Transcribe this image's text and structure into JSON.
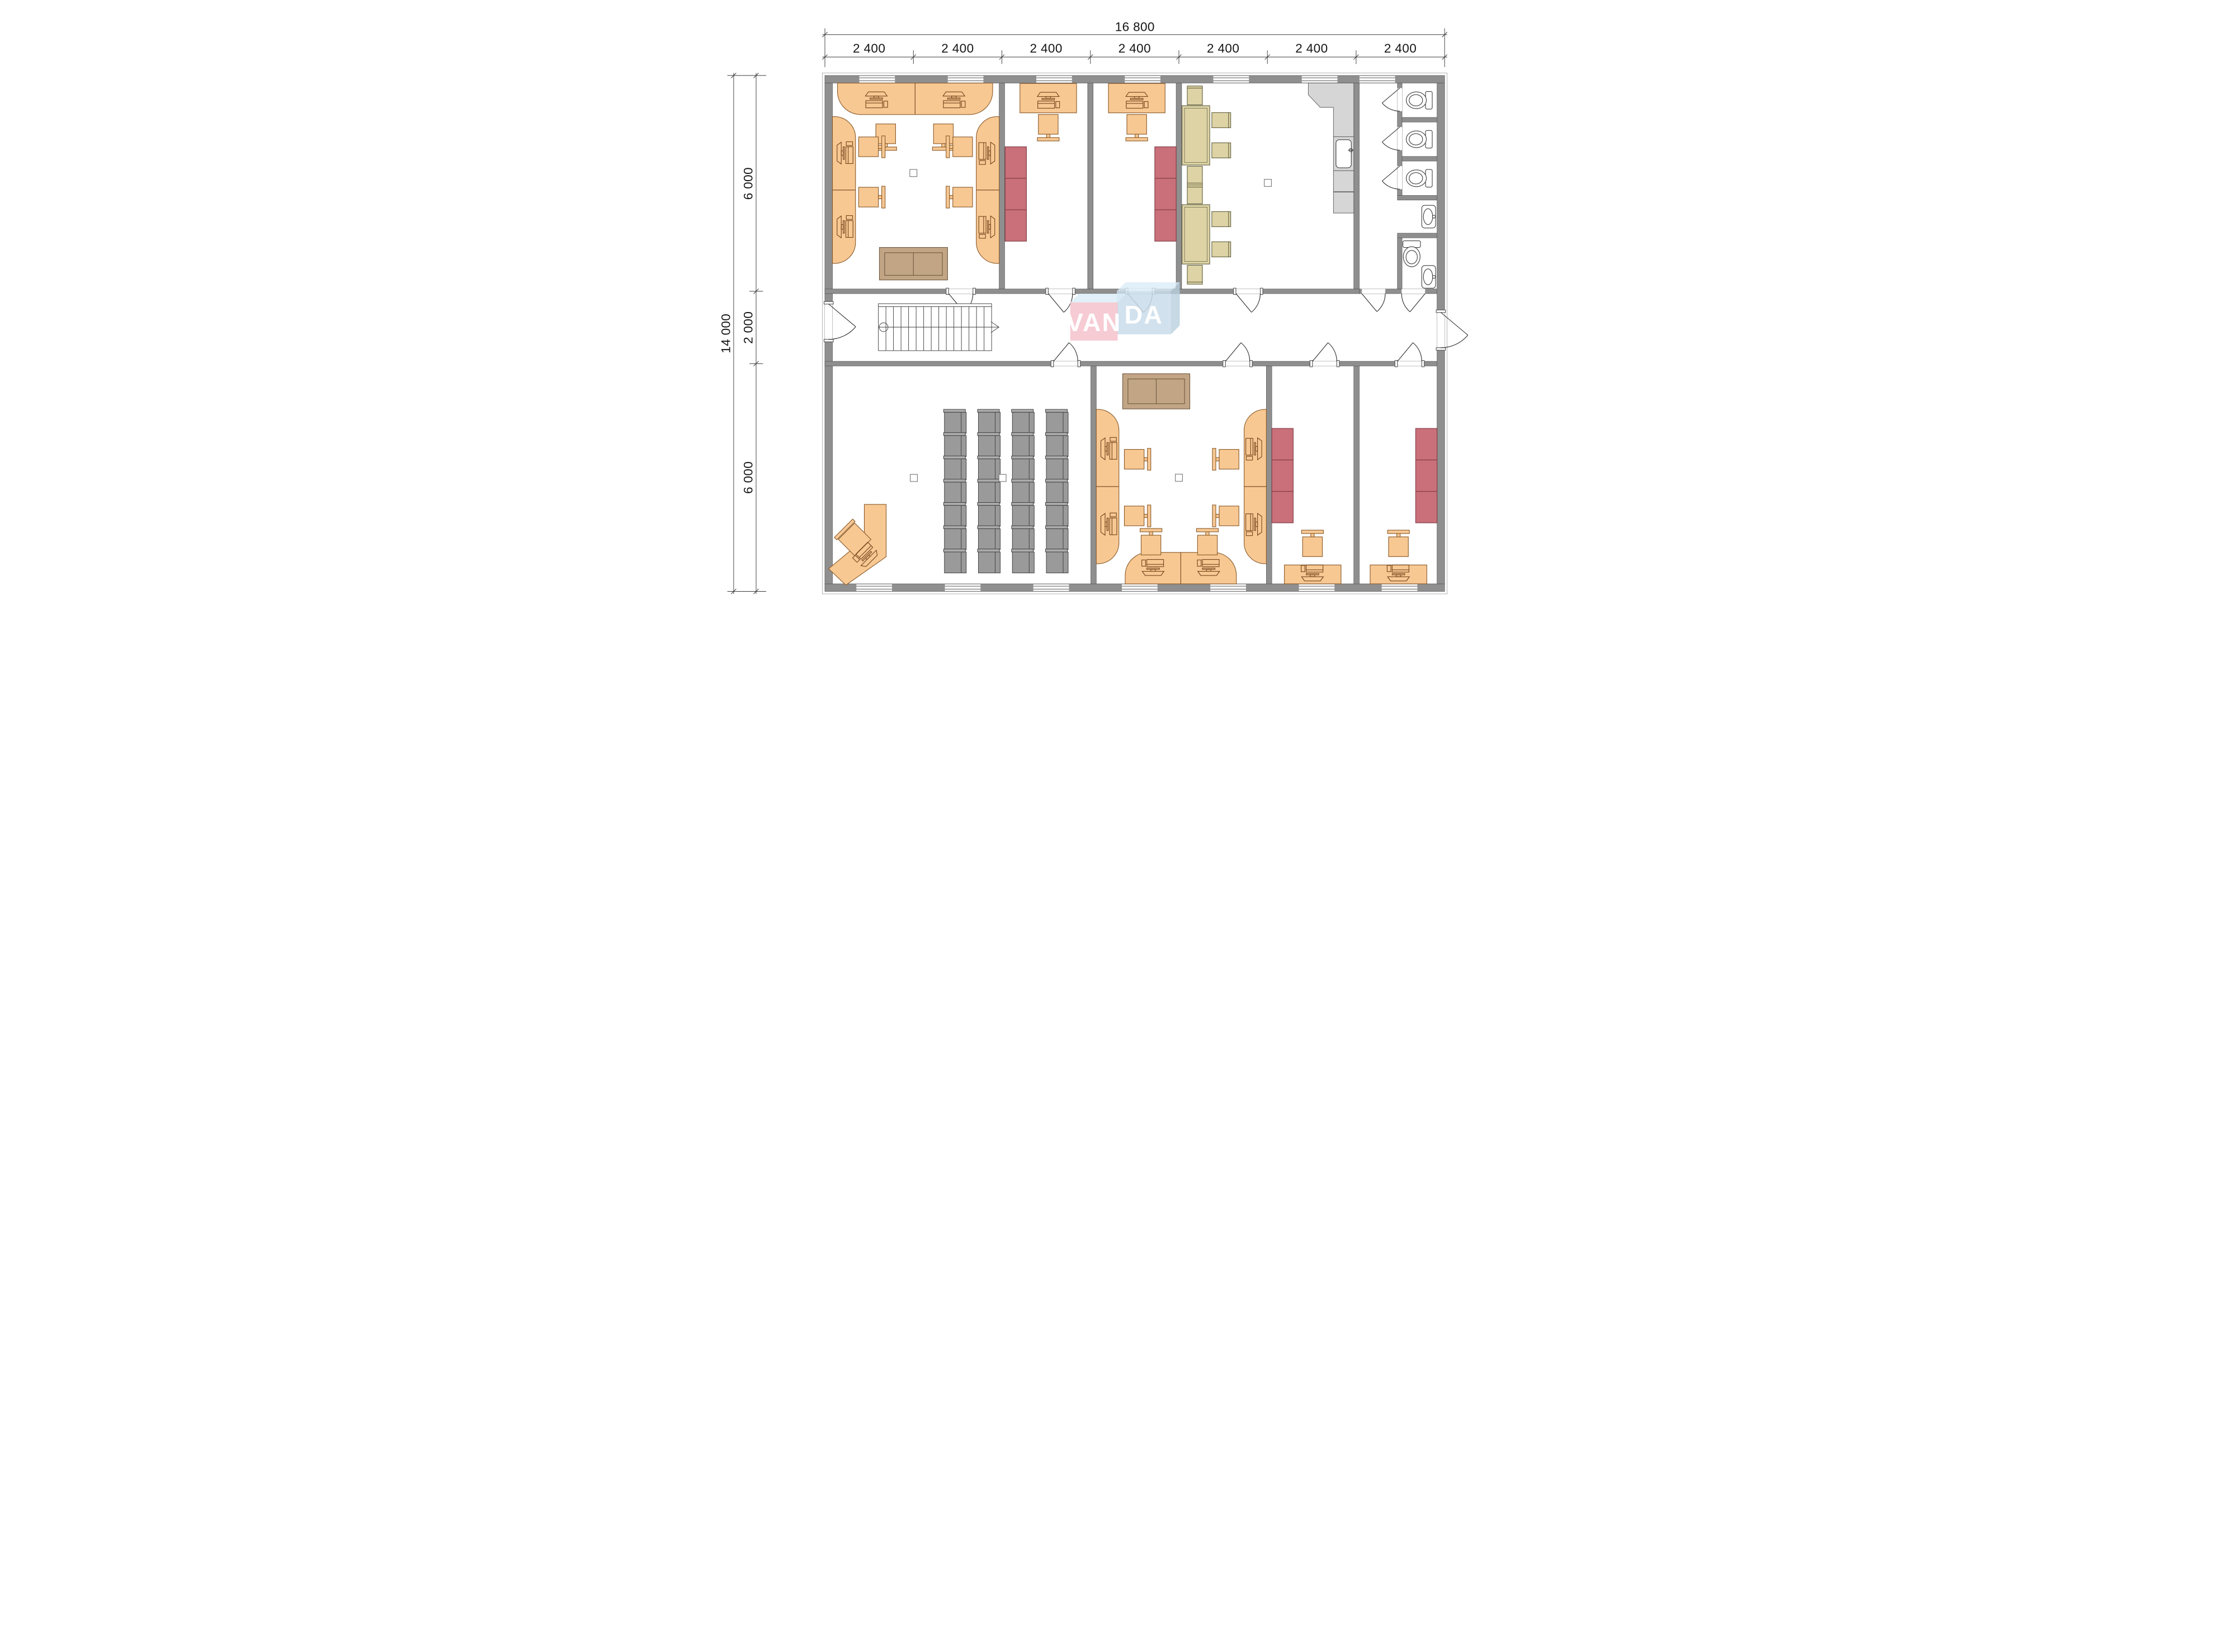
{
  "document": {
    "type": "architectural-floor-plan",
    "description": "Single-storey office building layout plan with furniture",
    "background": "#ffffff"
  },
  "branding": {
    "name": "VANDA",
    "front_text": "VAN",
    "back_text": "DA"
  },
  "dimensions": {
    "total_width_label": "16 800",
    "bay_width_label": "2 400",
    "bay_count": 7,
    "grid_width_labels": [
      "2 400",
      "2 400",
      "2 400",
      "2 400",
      "2 400",
      "2 400",
      "2 400"
    ],
    "total_height_label": "14 000",
    "height_segment_labels": [
      "6 000",
      "2 000",
      "6 000"
    ]
  },
  "colors": {
    "wall": "#8f8f8f",
    "furniture_orange": "#f8c893",
    "cabinet_red": "#c9707a",
    "table_tan": "#ddd3a5",
    "chair_gray": "#9a9a9a",
    "sofa_brown": "#c2a585",
    "kitchen_gray": "#d6d6d6",
    "fixture_white": "#ffffff",
    "logo_pink": "#f5c2cb",
    "logo_blue": "#c9dcea",
    "logo_top_face": "#d9ecf7",
    "logo_text": "#ffffff",
    "dimension_text": "#141414"
  },
  "rooms": [
    {
      "name": "open-office-top-left",
      "furniture": {
        "counter_workstations": 6,
        "chairs": 6,
        "sofas": 1,
        "columns": 1
      }
    },
    {
      "name": "private-office-1",
      "furniture": {
        "desks": 1,
        "chairs": 1,
        "red_cabinets": 1
      }
    },
    {
      "name": "private-office-2",
      "furniture": {
        "desks": 1,
        "chairs": 1,
        "red_cabinets": 1
      }
    },
    {
      "name": "break-room",
      "furniture": {
        "dining_tables": 2,
        "chairs": 8,
        "kitchen_counters": 1,
        "sinks": 1,
        "columns": 1
      }
    },
    {
      "name": "sanitary-block",
      "furniture": {
        "toilet_stalls": 3,
        "toilets": 4,
        "wash_basins": 2
      }
    },
    {
      "name": "corridor",
      "furniture": {
        "staircases": 1,
        "entrance_doors": 2
      }
    },
    {
      "name": "training-room",
      "furniture": {
        "chairs": 28,
        "chair_grid": "4 x 7",
        "instructor_desks": 1,
        "columns": 2
      }
    },
    {
      "name": "open-office-bottom",
      "furniture": {
        "counter_workstations": 6,
        "chairs": 6,
        "sofas": 1,
        "columns": 1
      }
    },
    {
      "name": "private-office-3",
      "furniture": {
        "desks": 1,
        "chairs": 1,
        "red_cabinets": 1
      }
    },
    {
      "name": "private-office-4",
      "furniture": {
        "desks": 1,
        "chairs": 1,
        "red_cabinets": 1
      }
    }
  ]
}
